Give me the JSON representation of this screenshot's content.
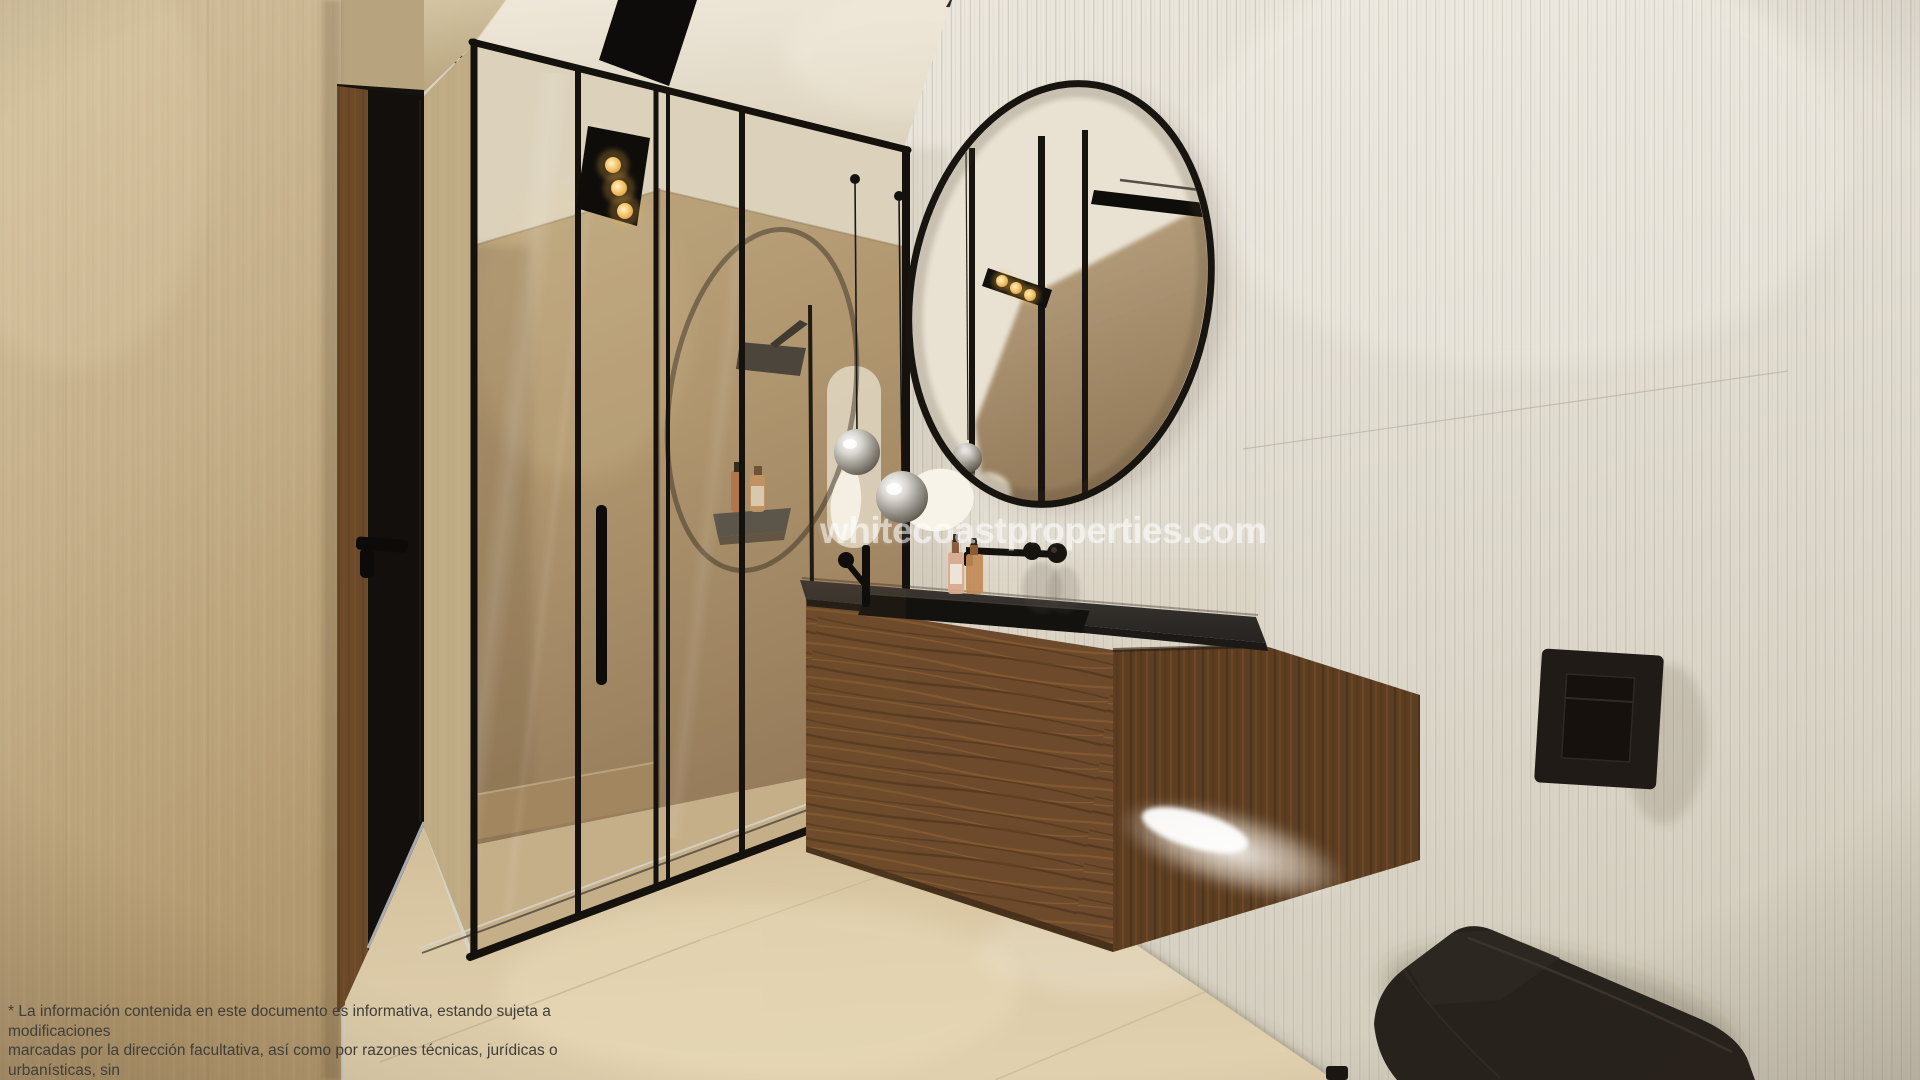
{
  "watermark": {
    "text": "whitecoastproperties.com"
  },
  "disclaimer": {
    "line1": "* La información contenida en este documento es informativa, estando sujeta a modificaciones",
    "line2": "marcadas por la dirección facultativa, así como por razones técnicas, jurídicas o urbanísticas, sin",
    "line3": "que ello pueda suponer reducir las calidades inicialmente previstas."
  },
  "palette": {
    "ceiling": "#e8e1d2",
    "wall_left": "#c5b089",
    "wall_right": "#e3ded3",
    "floor": "#d5c29e",
    "shower_wall": "#b49b74",
    "wood_front": "#6d4a2b",
    "wood_side": "#5e3e22",
    "countertop": "#2e2a26",
    "fixtures_black": "#15120e",
    "gold_light": "#f5c169",
    "glow_white": "#ffffff",
    "watermark_color": "rgba(255,255,255,0.55)",
    "disclaimer_color": "#403e38"
  }
}
